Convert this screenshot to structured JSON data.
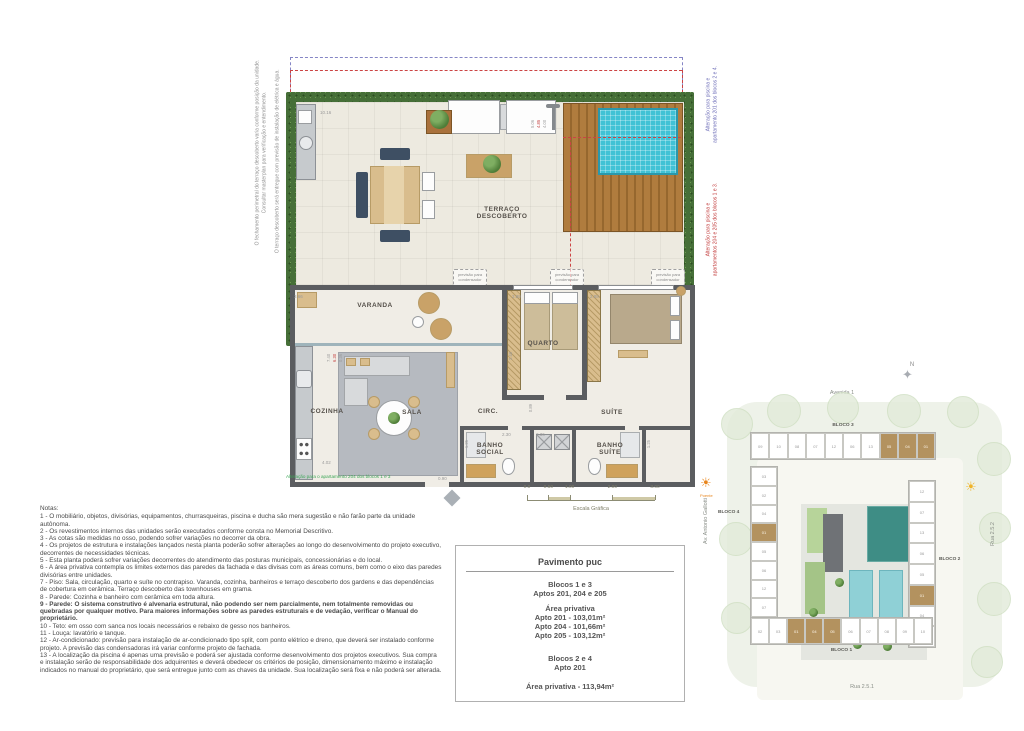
{
  "floor_plan": {
    "side_note_left_1": "O fechamento perimetral do terraço descoberto varia conforme posição da unidade.\nConsultar masterplan para verificação e entendimento.",
    "side_note_left_2": "O terraço descoberto será entregue com previsão de instalação de elétrica e água.",
    "side_note_blue": "Alteração para piscina e\napartamento 201 dos blocos 2 e 4.",
    "side_note_red": "Alteração para piscina e\napartamentos 204 e 205 dos blocos 1 e 3.",
    "terrace_label": "TERRAÇO\nDESCOBERTO",
    "condenser_label": "previsão para\ncondensador",
    "rooms": {
      "varanda": "VARANDA",
      "cozinha": "COZINHA",
      "sala": "SALA",
      "circ": "CIRC.",
      "quarto": "QUARTO",
      "suite": "SUÍTE",
      "banho_social": "BANHO\nSOCIAL",
      "banho_suite": "BANHO\nSUÍTE"
    },
    "alteration_note_green": "Alteração para o apartamento 204 dos blocos 1 e 3",
    "dims": {
      "terrace_width": "10.16",
      "varanda_corner": "3.66",
      "quarto_width": "2.89",
      "suite_width": "2.88",
      "quarto_depth": "2.48",
      "cozinha_width": "4.02",
      "entry": "0.90",
      "banho_social_w": "2.30",
      "banho_suite_w": "2.36",
      "banho_social_h": "1.25",
      "banho_suite_h": "1.25",
      "circ_w": "0.89",
      "pool_stack": [
        "5.06",
        "4.85",
        "4.00"
      ],
      "varanda_stack": [
        "7.40",
        "6.30",
        "0.36"
      ]
    },
    "scale": {
      "ticks": [
        "0.0",
        "0.50",
        "1.00",
        "2.00",
        "3.00"
      ],
      "label": "Escala Gráfica"
    }
  },
  "notes": {
    "title": "Notas:",
    "items": [
      {
        "text": "1 - O mobiliário, objetos, divisórias, equipamentos, churrasqueiras, piscina e ducha são mera sugestão e não farão parte da unidade autônoma.",
        "bold": false
      },
      {
        "text": "2 - Os revestimentos internos das unidades serão executados conforme consta no Memorial Descritivo.",
        "bold": false
      },
      {
        "text": "3 - As cotas são medidas no osso, podendo sofrer variações no decorrer da obra.",
        "bold": false
      },
      {
        "text": "4 - Os projetos de estrutura e instalações lançados nesta planta poderão sofrer alterações ao longo do desenvolvimento do projeto executivo, decorrentes de necessidades técnicas.",
        "bold": false
      },
      {
        "text": "5 - Esta planta poderá sofrer variações decorrentes do atendimento das posturas municipais, concessionárias e do local.",
        "bold": false
      },
      {
        "text": "6 - A área privativa contempla os limites externos das paredes da fachada e das divisas com as áreas comuns, bem como o eixo das paredes divisórias entre unidades.",
        "bold": false
      },
      {
        "text": "7 - Piso: Sala, circulação, quarto e suíte no contrapiso. Varanda, cozinha, banheiros e terraço descoberto dos gardens e das dependências de cobertura em cerâmica. Terraço descoberto das townhouses em grama.",
        "bold": false
      },
      {
        "text": "8 - Parede: Cozinha e banheiro com cerâmica em toda altura.",
        "bold": false
      },
      {
        "text": "9 - Parede: O sistema construtivo é alvenaria estrutural, não podendo ser nem parcialmente, nem totalmente removidas ou quebradas por qualquer motivo. Para maiores informações sobre as paredes estruturais e de vedação, verificar o Manual do proprietário.",
        "bold": true
      },
      {
        "text": "10 - Teto: em osso com sanca nos locais necessários e rebaixo de gesso nos banheiros.",
        "bold": false
      },
      {
        "text": "11 - Louça: lavatório e tanque.",
        "bold": false
      },
      {
        "text": "12 - Ar-condicionado: previsão para instalação de ar-condicionado tipo split, com ponto elétrico e dreno, que deverá ser instalado conforme projeto. A previsão das condensadoras irá variar conforme projeto de fachada.",
        "bold": false
      },
      {
        "text": "13 - A localização da piscina é apenas uma previsão e poderá ser ajustada conforme desenvolvimento dos projetos executivos. Sua compra e instalação serão de responsabilidade dos adquirentes e deverá obedecer os critérios de posição, dimensionamento máximo e instalação indicados no manual do proprietário, que será entregue junto com as chaves da unidade. Sua localização será fixa e não poderá ser alterada.",
        "bold": false
      }
    ]
  },
  "info_box": {
    "title": "Pavimento puc",
    "b13_title": "Blocos 1 e 3",
    "b13_sub": "Aptos 201, 204 e 205",
    "area_title": "Área privativa",
    "b13_areas": [
      "Apto 201 - 103,01m²",
      "Apto 204 - 101,66m²",
      "Apto 205 - 103,12m²"
    ],
    "b24_title": "Blocos 2 e 4",
    "b24_sub": "Apto 201",
    "b24_area": "Área privativa - 113,94m²"
  },
  "site_plan": {
    "north_label": "N",
    "streets": {
      "top": "Avenida 1",
      "bottom": "Rua 2.5.1",
      "right": "Rua 2.5.2",
      "left": "Av. Antonio Gallotti"
    },
    "sun_left_label": "Poente",
    "blocks": [
      {
        "name": "BLOCO 3",
        "units": [
          {
            "n": "09"
          },
          {
            "n": "10"
          },
          {
            "n": "08"
          },
          {
            "n": "07"
          },
          {
            "n": "12"
          },
          {
            "n": "06"
          },
          {
            "n": "13"
          },
          {
            "n": "05",
            "hl": true
          },
          {
            "n": "04",
            "hl": true
          },
          {
            "n": "01",
            "hl": true
          }
        ]
      },
      {
        "name": "BLOCO 4",
        "units": [
          {
            "n": "03"
          },
          {
            "n": "02"
          },
          {
            "n": "04"
          },
          {
            "n": "01",
            "hl": true
          },
          {
            "n": "05"
          },
          {
            "n": "06"
          },
          {
            "n": "12"
          },
          {
            "n": "07"
          }
        ]
      },
      {
        "name": "BLOCO 2",
        "units": [
          {
            "n": "12"
          },
          {
            "n": "07"
          },
          {
            "n": "13"
          },
          {
            "n": "06"
          },
          {
            "n": "05"
          },
          {
            "n": "01",
            "hl": true
          },
          {
            "n": "04"
          },
          {
            "n": "02"
          }
        ]
      },
      {
        "name": "BLOCO 1",
        "units": [
          {
            "n": "02"
          },
          {
            "n": "03"
          },
          {
            "n": "01",
            "hl": true
          },
          {
            "n": "04",
            "hl": true
          },
          {
            "n": "05",
            "hl": true
          },
          {
            "n": "06"
          },
          {
            "n": "07"
          },
          {
            "n": "08"
          },
          {
            "n": "09"
          },
          {
            "n": "10"
          }
        ]
      }
    ]
  },
  "colors": {
    "wall": "#5b5d60",
    "pool": "#41c2d5",
    "deck_wood": "#b07c3e",
    "hedge": "#436b35",
    "unit_highlight": "#b3925f",
    "alteration_red": "#c23b3b",
    "alteration_blue": "#6e6eb8",
    "alteration_green": "#3aa655"
  }
}
